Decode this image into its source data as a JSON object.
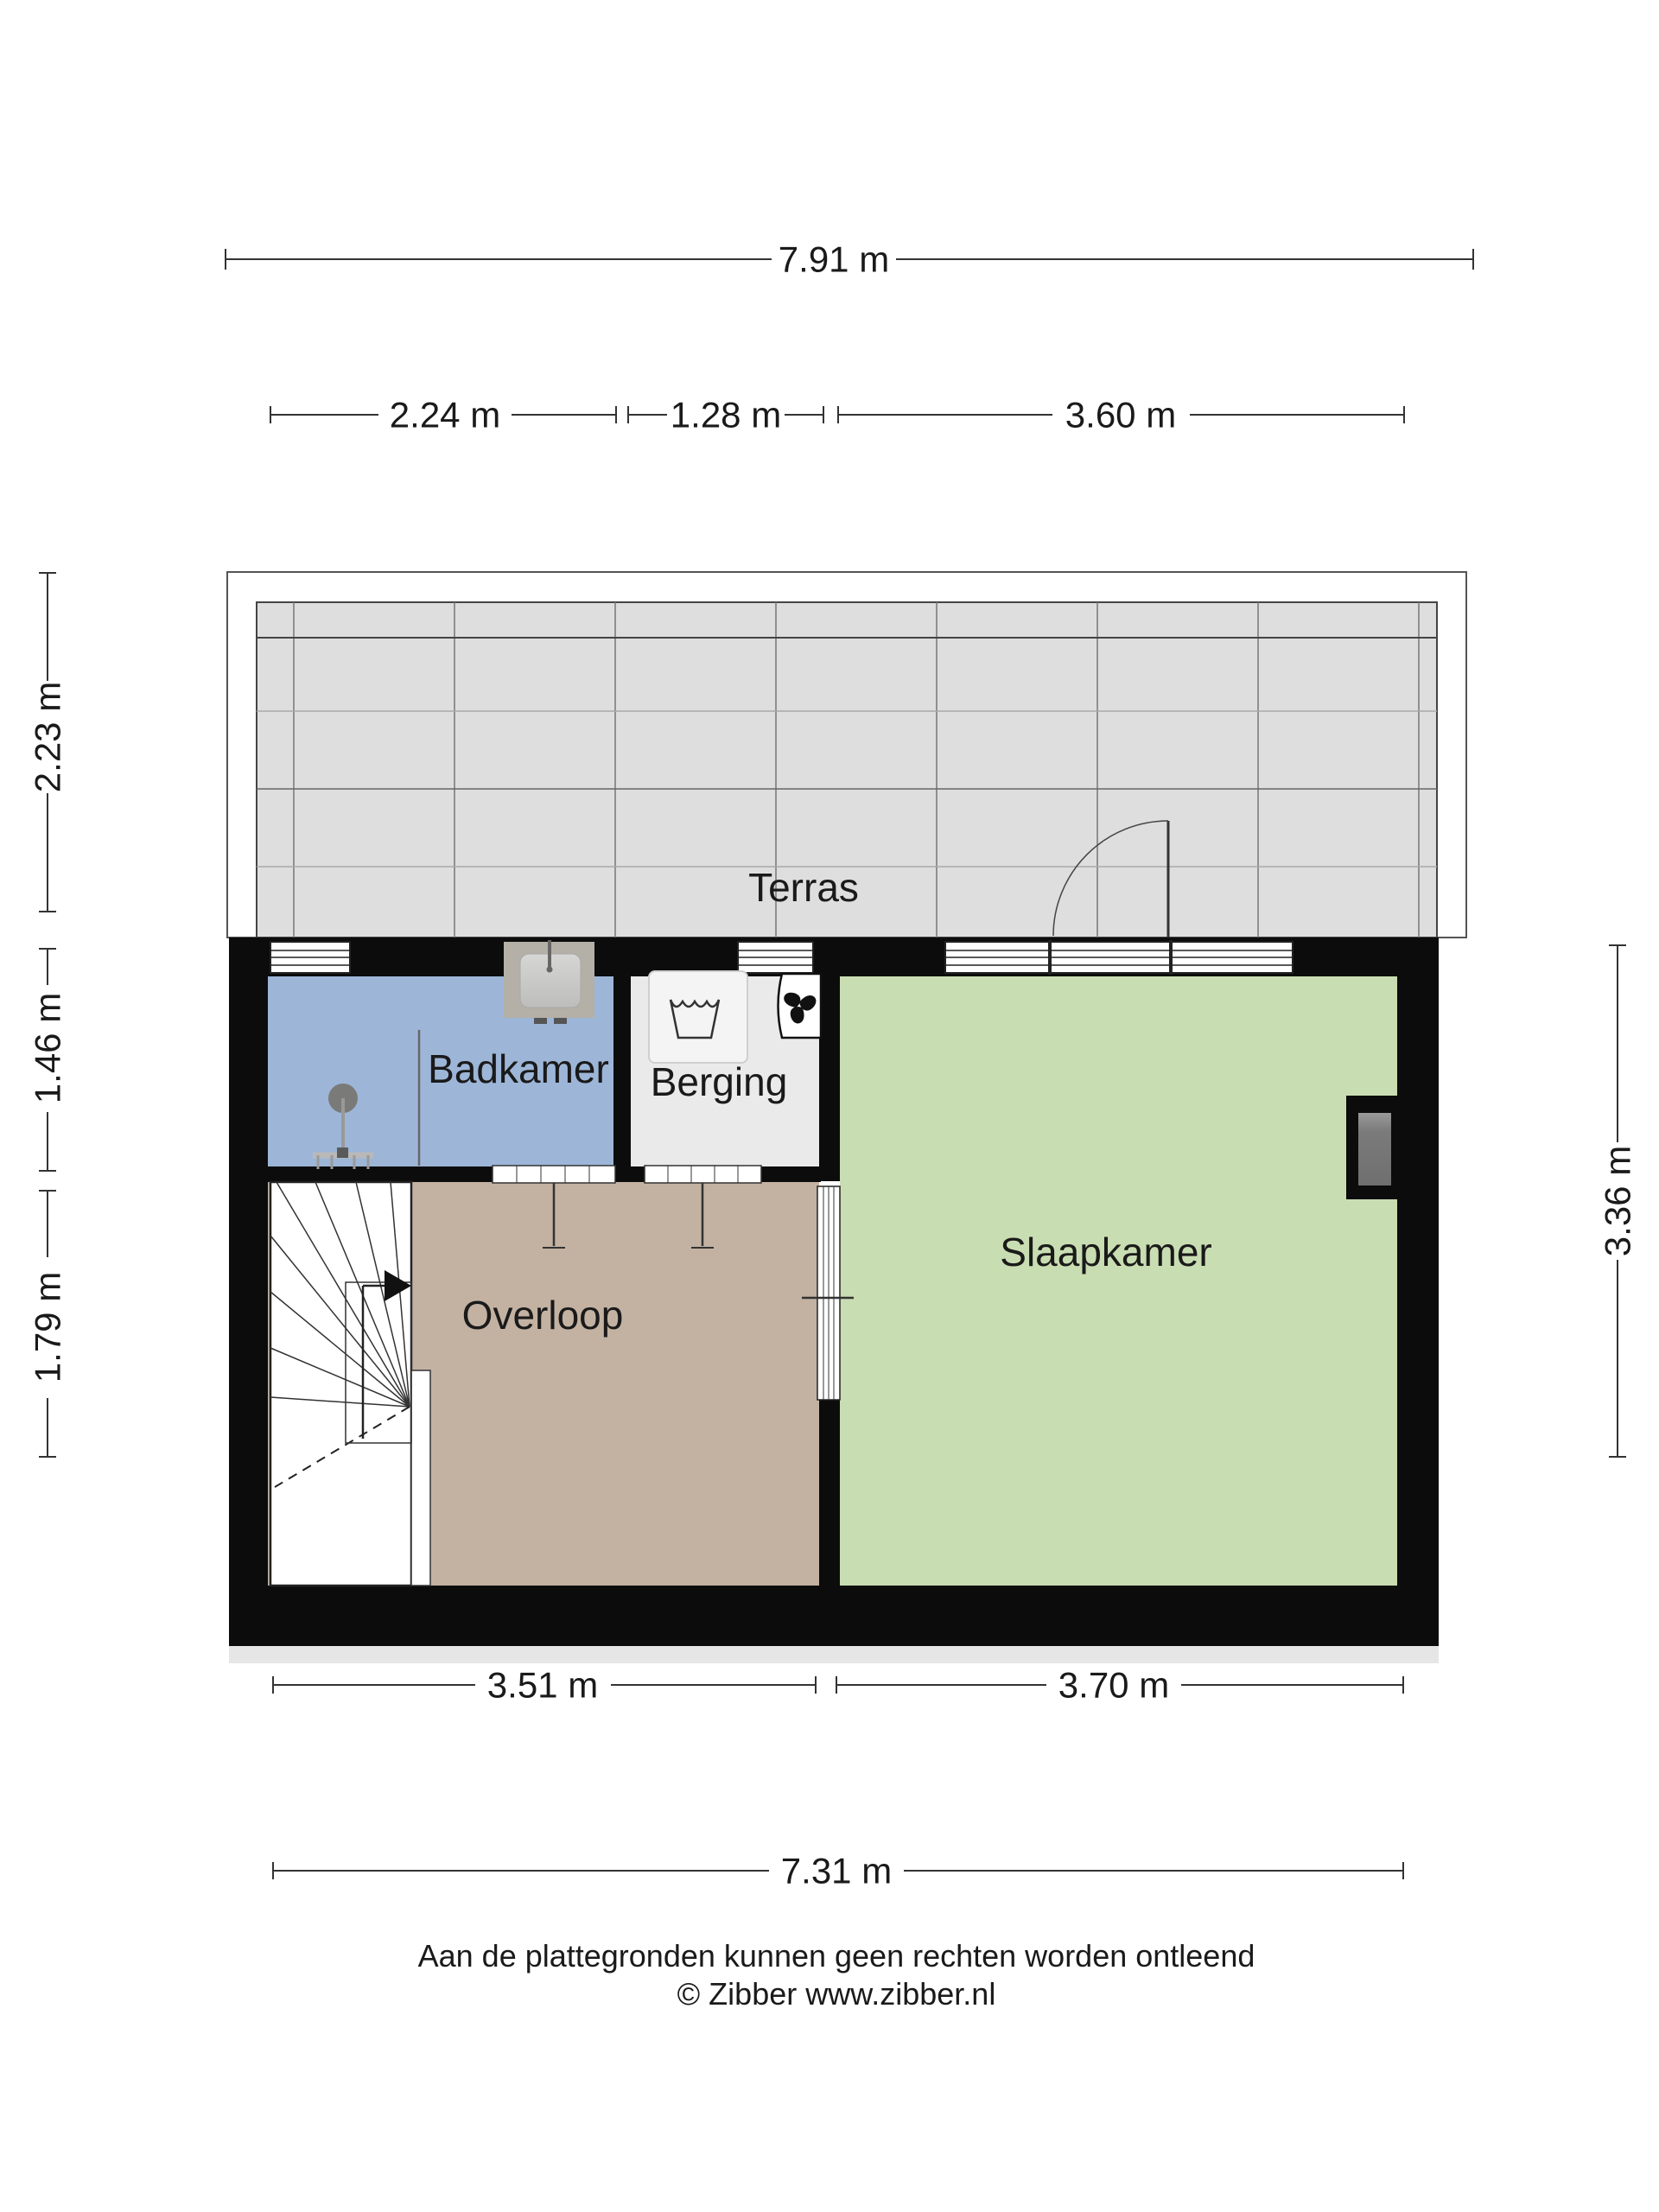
{
  "rooms": {
    "terras": {
      "label": "Terras"
    },
    "badkamer": {
      "label": "Badkamer"
    },
    "berging": {
      "label": "Berging"
    },
    "slaapkamer": {
      "label": "Slaapkamer"
    },
    "overloop": {
      "label": "Overloop"
    }
  },
  "dimensions": {
    "top_total": "7.91 m",
    "top_segments": [
      "2.24 m",
      "1.28 m",
      "3.60 m"
    ],
    "left": [
      "2.23 m",
      "1.46 m",
      "1.79 m"
    ],
    "right": "3.36 m",
    "bottom_segments": [
      "3.51 m",
      "3.70 m"
    ],
    "bottom_total": "7.31 m"
  },
  "footer": {
    "disclaimer": "Aan de plattegronden kunnen geen rechten worden ontleend",
    "credit": "© Zibber www.zibber.nl"
  },
  "colors": {
    "wall": "#0c0c0c",
    "terras_tiles": "#dedede",
    "badkamer": "#9db6d8",
    "berging": "#eaeaea",
    "slaapkamer": "#c9ddb2",
    "overloop": "#c3b2a2"
  }
}
